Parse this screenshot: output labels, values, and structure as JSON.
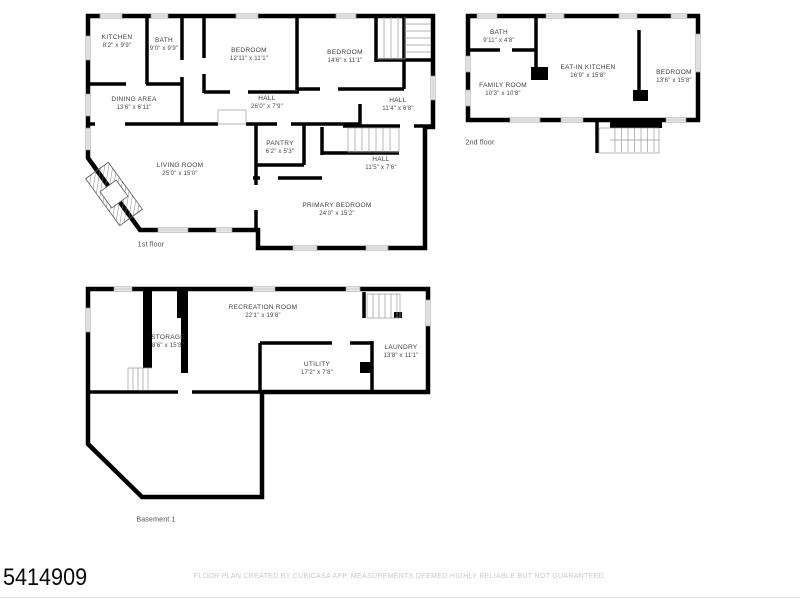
{
  "page": {
    "listing_id": "5414909",
    "disclaimer": "FLOOR PLAN CREATED BY CUBICASA APP. MEASUREMENTS DEEMED HIGHLY RELIABLE BUT NOT GUARANTEED."
  },
  "colors": {
    "wall": "#000000",
    "room_fill": "#ffffff",
    "label_text": "#3d3d3d",
    "disclaimer_text": "#c9c9c9"
  },
  "floors": [
    {
      "caption": "1st floor",
      "rooms": [
        {
          "name": "KITCHEN",
          "dims": "8'2\" x 9'9\""
        },
        {
          "name": "BATH",
          "dims": "9'0\" x 9'9\""
        },
        {
          "name": "BEDROOM",
          "dims": "12'11\" x 11'1\""
        },
        {
          "name": "BEDROOM",
          "dims": "14'6\" x 11'1\""
        },
        {
          "name": "DINING AREA",
          "dims": "13'6\" x 6'11\""
        },
        {
          "name": "HALL",
          "dims": "26'0\" x 7'9\""
        },
        {
          "name": "HALL",
          "dims": "11'4\" x 6'8\""
        },
        {
          "name": "PANTRY",
          "dims": "6'2\" x 5'3\""
        },
        {
          "name": "LIVING ROOM",
          "dims": "25'0\" x 15'0\""
        },
        {
          "name": "HALL",
          "dims": "11'5\" x 7'6\""
        },
        {
          "name": "PRIMARY BEDROOM",
          "dims": "24'0\" x 15'2\""
        }
      ]
    },
    {
      "caption": "2nd floor",
      "rooms": [
        {
          "name": "BATH",
          "dims": "9'11\" x 4'8\""
        },
        {
          "name": "FAMILY ROOM",
          "dims": "10'3\" x 10'8\""
        },
        {
          "name": "EAT-IN KITCHEN",
          "dims": "16'9\" x 15'8\""
        },
        {
          "name": "BEDROOM",
          "dims": "13'6\" x 15'8\""
        }
      ]
    },
    {
      "caption": "Basement 1",
      "rooms": [
        {
          "name": "RECREATION ROOM",
          "dims": "22'1\" x 19'8\""
        },
        {
          "name": "STORAGE",
          "dims": "8'6\" x 15'8\""
        },
        {
          "name": "UTILITY",
          "dims": "17'2\" x 7'8\""
        },
        {
          "name": "LAUNDRY",
          "dims": "13'8\" x 11'1\""
        }
      ]
    }
  ]
}
